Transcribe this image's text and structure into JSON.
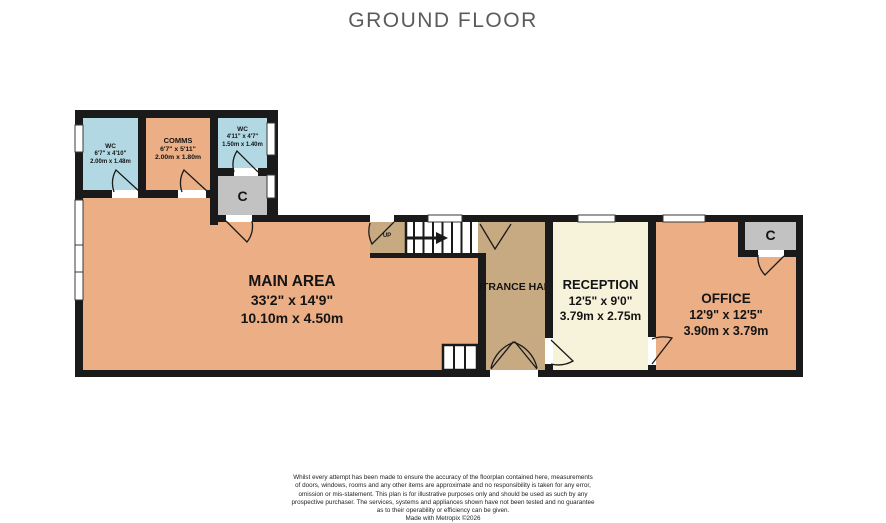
{
  "title": "GROUND FLOOR",
  "colors": {
    "wall": "#1a1a1a",
    "floor_tan": "#EBAE85",
    "floor_dark_tan": "#C7A982",
    "floor_cream": "#F7F3DB",
    "floor_blue": "#B2D9E3",
    "closet_gray": "#C2C2C2",
    "window_white": "#ffffff"
  },
  "rooms": {
    "wc1": {
      "name": "WC",
      "imperial": "6'7\" x 4'10\"",
      "metric": "2.00m x 1.48m"
    },
    "comms": {
      "name": "COMMS",
      "imperial": "6'7\" x 5'11\"",
      "metric": "2.00m x 1.80m"
    },
    "wc2": {
      "name": "WC",
      "imperial": "4'11\" x 4'7\"",
      "metric": "1.50m x 1.40m"
    },
    "closet1": {
      "name": "C"
    },
    "main_area": {
      "name": "MAIN AREA",
      "imperial": "33'2\" x 14'9\"",
      "metric": "10.10m x 4.50m"
    },
    "entrance_hall": {
      "name": "ENTRANCE HALL"
    },
    "reception": {
      "name": "RECEPTION",
      "imperial": "12'5\" x 9'0\"",
      "metric": "3.79m x 2.75m"
    },
    "office": {
      "name": "OFFICE",
      "imperial": "12'9\" x 12'5\"",
      "metric": "3.90m x 3.79m"
    },
    "closet2": {
      "name": "C"
    },
    "stairs": {
      "label": "UP"
    }
  },
  "footer": {
    "lines": [
      "Whilst every attempt has been made to ensure the accuracy of the floorplan contained here, measurements",
      "of doors, windows, rooms and any other items are approximate and no responsibility is taken for any error,",
      "omission or mis-statement. This plan is for illustrative purposes only and should be used as such by any",
      "prospective purchaser. The services, systems and appliances shown have not been tested and no guarantee",
      "as to their operability or efficiency can be given.",
      "Made with Metropix ©2026"
    ]
  }
}
